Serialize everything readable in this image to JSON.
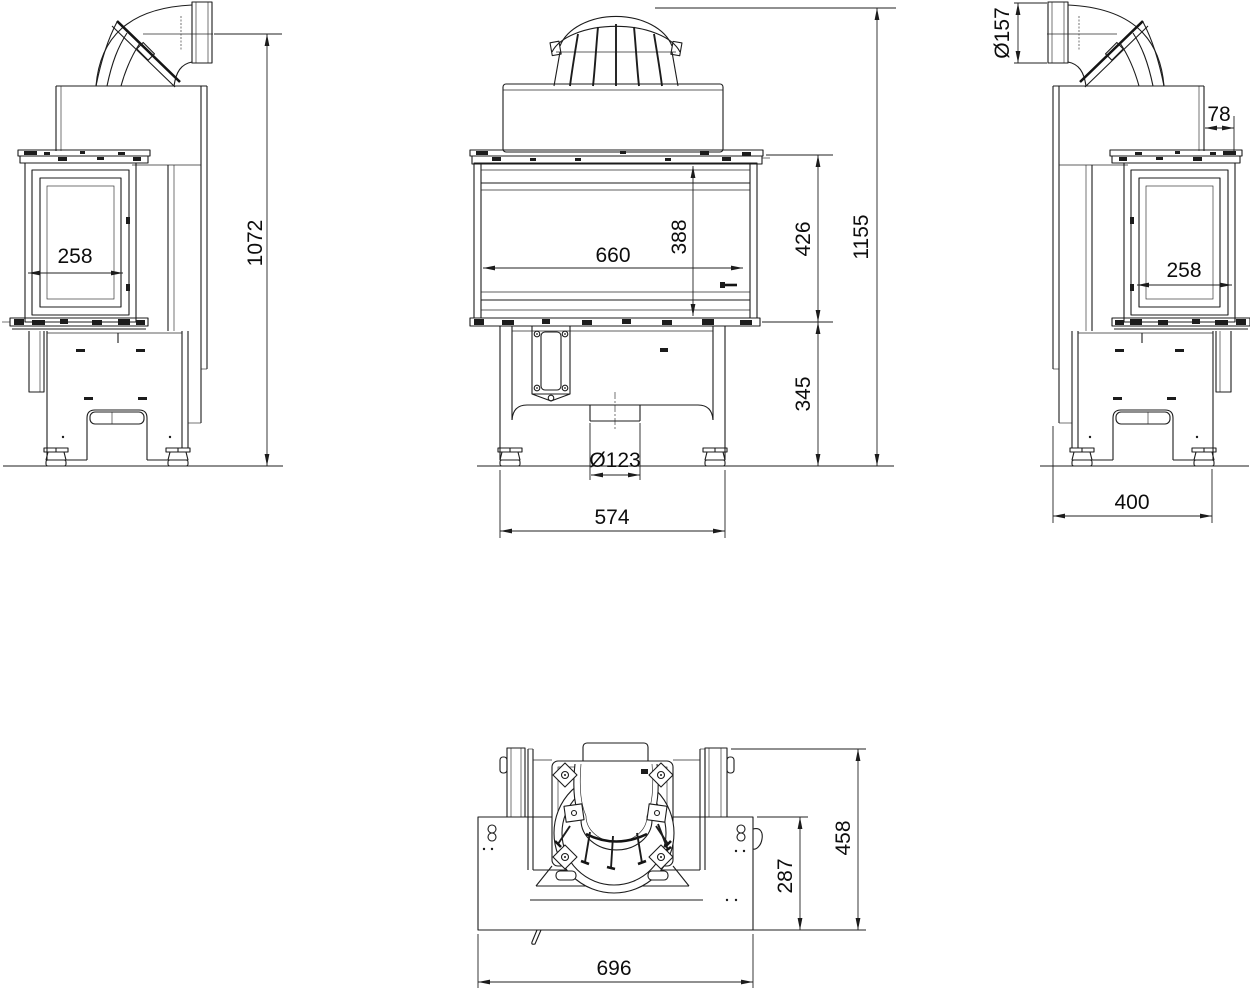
{
  "colors": {
    "line": "#1c1c1c",
    "background": "#ffffff"
  },
  "views": {
    "side_left": {
      "label": "left side view",
      "dims": {
        "glass_depth": "258",
        "overall_height": "1072"
      }
    },
    "front": {
      "label": "front view",
      "dims": {
        "glass_width": "660",
        "glass_height": "388",
        "firebox_height": "426",
        "overall_height": "1155",
        "base_height": "345",
        "air_inlet_diameter": "Ø123",
        "base_width": "574"
      }
    },
    "side_right": {
      "label": "right side view",
      "dims": {
        "flue_diameter": "Ø157",
        "top_rear_offset": "78",
        "glass_depth": "258",
        "base_depth": "400"
      }
    },
    "plan": {
      "label": "plan view",
      "dims": {
        "body_depth": "287",
        "overall_depth": "458",
        "body_width": "696"
      }
    }
  }
}
